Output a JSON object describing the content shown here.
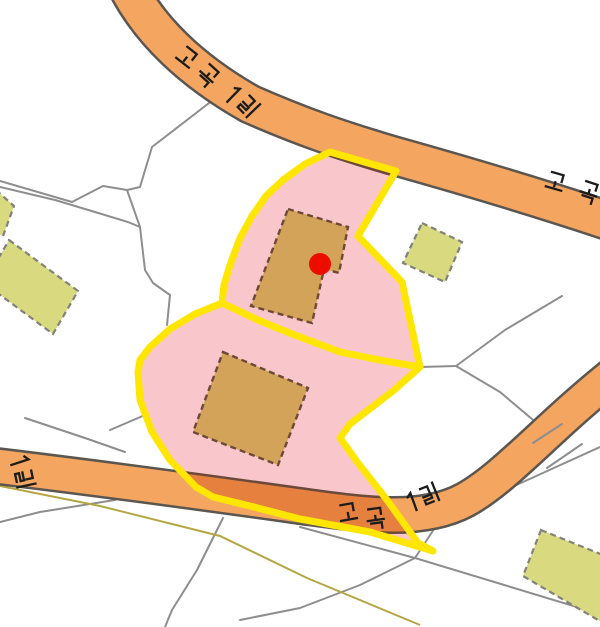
{
  "map": {
    "road_name_label": "고곡1길",
    "labels": {
      "top_road": "고곡1길",
      "right_road": "고곡1길",
      "bottom_road": "고곡1길",
      "left_road": "1길"
    },
    "marker": {
      "color": "#ee0b00"
    },
    "colors": {
      "background": "#ffffff",
      "road_fill": "#f4a55f",
      "road_casing": "#5b5650",
      "road_inside_parcel_fill": "#e5803f",
      "road_inside_parcel_casing": "#6b4a3a",
      "parcel_fill": "#f9c6cc",
      "parcel_outline": "#ffe600",
      "building_fill": "#d2a358",
      "building_outline": "#6f4937",
      "annex_building_fill": "#d9d97f",
      "annex_building_outline": "#82827a",
      "boundary_line": "#8e8e8e",
      "trail_line": "#b5a642",
      "label_color": "#1c1c1c"
    }
  }
}
